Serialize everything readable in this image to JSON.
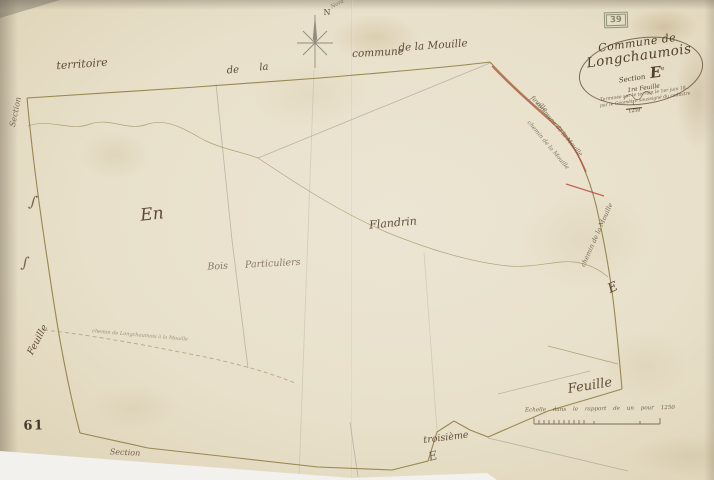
{
  "stamp": {
    "number": "39"
  },
  "compass": {
    "label": "N",
    "scribble": "Nord"
  },
  "cartouche": {
    "title_line1": "Commune de",
    "title_line2": "Longchaumois",
    "section_word": "Section",
    "section_letter": "E",
    "section_sup": "e",
    "sub_line": "1re Feuille",
    "fine_print_1": "Terminée sur le terrain le 1er juin 18..",
    "fine_print_2": "par le Géomètre soussigné du cadastre",
    "fraction_numerator": "1",
    "fraction_denominator": "1250"
  },
  "neighbour_labels": {
    "territoire": "territoire",
    "de": "de",
    "la": "la",
    "commune": "commune",
    "de_la_mouille": "de la Mouille"
  },
  "road_labels": {
    "feuille_small": "feuille",
    "commune_mouille": "commune de la Mouille",
    "chemin_mouille": "chemin de la Mouille",
    "chemin_vertical": "chemin de la Mouille",
    "letter_e": "E"
  },
  "place_labels": {
    "en": "En",
    "flandrin": "Flandrin",
    "bois_particuliers": "Bois Particuliers",
    "path_note": "chemin de Longchaumois à la Mouille"
  },
  "edge_labels": {
    "left_section": "Section",
    "left_feuille": "Feuille",
    "bottom_section": "Section",
    "bottom_troisieme": "troisième",
    "bottom_flourish": "E",
    "right_feuille": "Feuille",
    "marginal_s1": "∫",
    "marginal_s2": "∫"
  },
  "corner_number": "61",
  "scale": {
    "caption": "Echelle dans le rapport de un pour 1250"
  },
  "colors": {
    "paper": "#e8e0ca",
    "boundary": "#8a783c",
    "road_red": "#b5483a",
    "ink": "#5f4c38",
    "pencil": "#8d887b"
  }
}
